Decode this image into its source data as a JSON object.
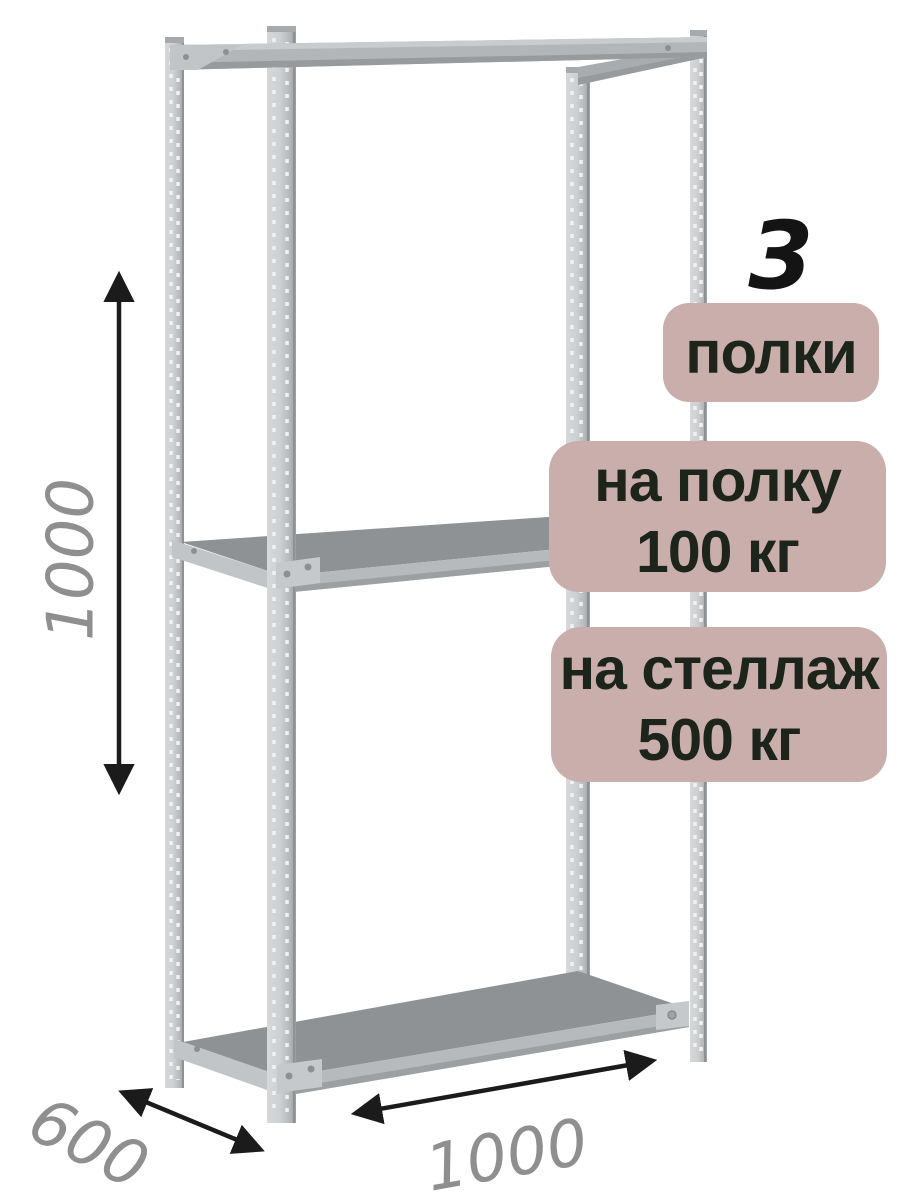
{
  "product_image": {
    "shelf_count": "3",
    "badges": {
      "shelves": {
        "label": "полки"
      },
      "per_shelf": {
        "line1": "на полку",
        "line2": "100 кг"
      },
      "per_rack": {
        "line1": "на стеллаж",
        "line2": "500 кг"
      }
    },
    "dimensions": {
      "height": "1000",
      "depth": "600",
      "width": "1000"
    }
  },
  "colors": {
    "badge_background": "#c9aeac",
    "badge_text": "#1d241c",
    "dimension_label": "#8f8f8f",
    "arrow": "#1b1b1b",
    "metal_mid": "#b3b6b8",
    "metal_dark": "#989b9d",
    "shelf_top": "#8e9295",
    "shelf_front": "#b7babc",
    "shelf_side": "#c2c5c7",
    "plate": "#c6c9cb"
  }
}
